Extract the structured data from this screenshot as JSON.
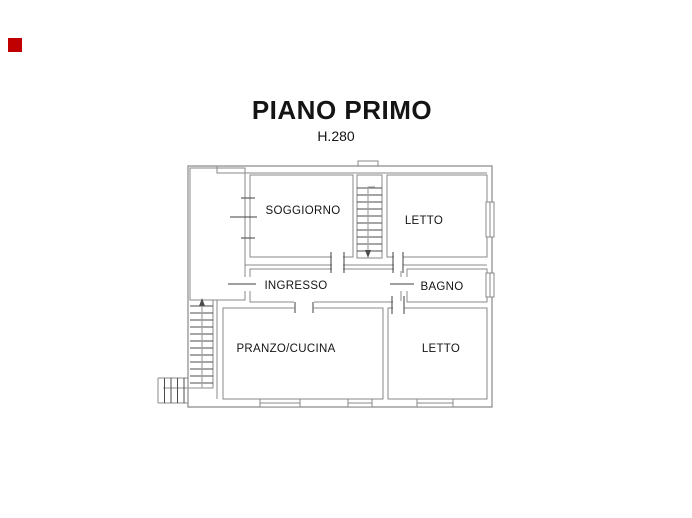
{
  "marker": {
    "color": "#c00000"
  },
  "title": {
    "text": "PIANO PRIMO",
    "height_label": "H.280"
  },
  "plan": {
    "rooms": [
      {
        "label": "SOGGIORNO"
      },
      {
        "label": "LETTO"
      },
      {
        "label": "INGRESSO"
      },
      {
        "label": "BAGNO"
      },
      {
        "label": "PRANZO/CUCINA"
      },
      {
        "label": "LETTO"
      }
    ],
    "colors": {
      "wall": "#8a8a8a",
      "detail": "#4c4c4c",
      "text": "#141414",
      "background": "#ffffff"
    }
  }
}
